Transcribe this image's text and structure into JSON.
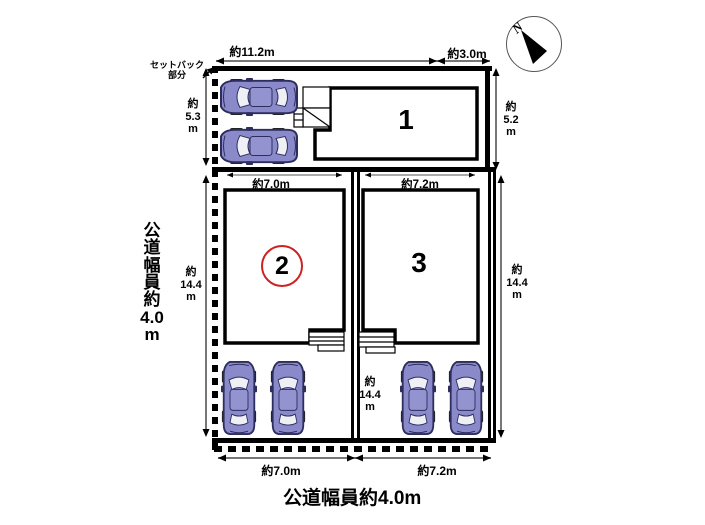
{
  "compass": {
    "label": "N"
  },
  "road": {
    "left_lines": [
      "公",
      "道",
      "幅",
      "員",
      "約",
      "4.0",
      "m"
    ],
    "bottom_label": "公道幅員約4.0m"
  },
  "setback": {
    "line1": "セットバック",
    "line2": "部分"
  },
  "lots": {
    "lot1": "1",
    "lot2": "2",
    "lot3": "3"
  },
  "dims": {
    "top_main": "約11.2m",
    "top_right": "約3.0m",
    "left_upper": [
      "約",
      "5.3",
      "m"
    ],
    "right_upper": [
      "約",
      "5.2",
      "m"
    ],
    "left_lower": [
      "約",
      "14.4",
      "m"
    ],
    "mid_lower": [
      "約",
      "14.4",
      "m"
    ],
    "right_lower": [
      "約",
      "14.4",
      "m"
    ],
    "lot2_top": "約7.0m",
    "lot3_top": "約7.2m",
    "bottom_left": "約7.0m",
    "bottom_right": "約7.2m"
  },
  "colors": {
    "car_body": "#8a8aca",
    "car_outline": "#2d2d5e",
    "lot2_circle": "#cc2222",
    "dim_line": "#777777"
  }
}
